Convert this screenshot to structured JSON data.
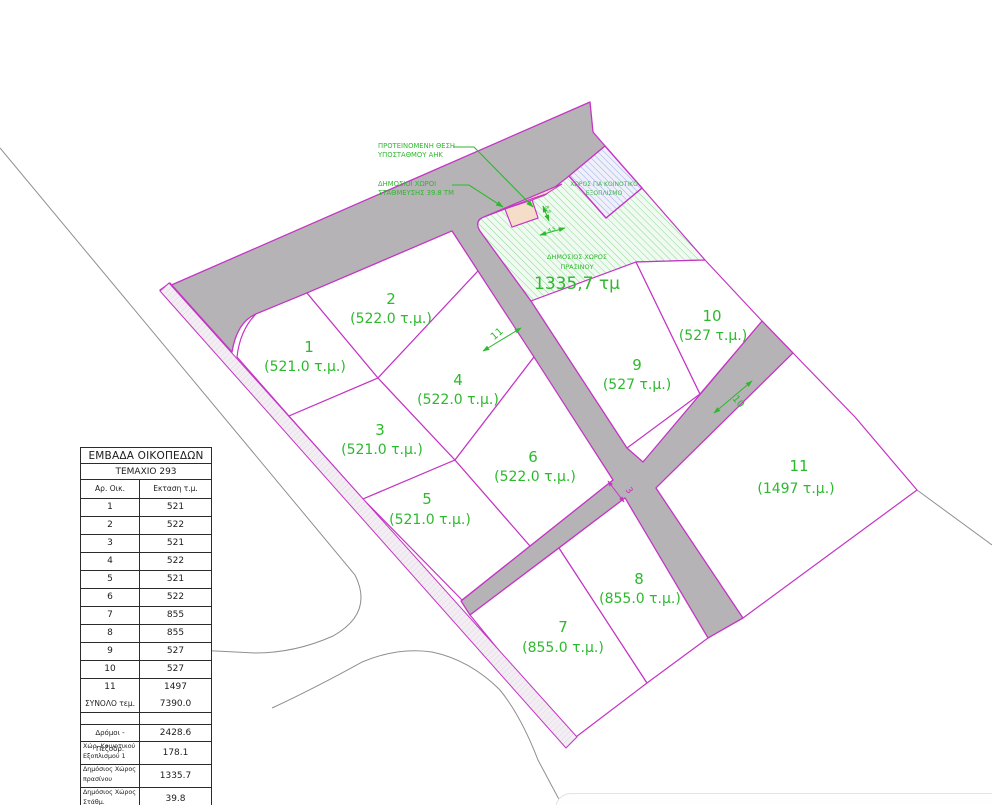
{
  "drawing_title": "Κατανομή οικοπέδων - σχέδιο διαχωρισμού",
  "colors": {
    "parcel_line_magenta": "#c435c4",
    "road_gray": "#b5b3b6",
    "plot_text_green": "#2db92d",
    "annotation_green": "#2db92d",
    "green_space_fill": "#effaf0",
    "green_space_hatch": "#8ed795",
    "community_fill": "#eef0fb",
    "community_hatch": "#9aa3dd",
    "parking_salmon": "#f6ddc9",
    "boundary_gray": "#8f8f8f",
    "table_text": "#1c1c1c"
  },
  "annotations": {
    "substation_line1": "ΠΡΟΤΕΙΝΟΜΕΝΗ ΘΕΣΗ",
    "substation_line2": "ΥΠΟΣΤΑΘΜΟΥ ΑΗΚ",
    "parking_line1": "ΔΗΜΟΣΙΟΙ ΧΩΡΟΙ",
    "parking_line2": "ΣΤΑΘΜΕΥΣΗΣ 39.8 ΤΜ",
    "community_line1": "ΧΩΡΟΣ ΓΙΑ ΚΟΙΝΟΤΙΚΟ",
    "community_line2": "ΕΞΟΠΛΙΣΜΟ",
    "green_line1": "ΔΗΜΟΣΙΟΣ ΧΩΡΟΣ",
    "green_line2": "ΠΡΑΣΙΝΟΥ",
    "green_area_value": "1335,7 τμ",
    "dim_road_11": "11",
    "dim_road_10": "10",
    "dim_path_3": "3",
    "dim_parking_h": "8.8",
    "dim_parking_w": "4.5"
  },
  "plots": [
    {
      "number": "1",
      "area_label": "(521.0 τ.μ.)"
    },
    {
      "number": "2",
      "area_label": "(522.0 τ.μ.)"
    },
    {
      "number": "3",
      "area_label": "(521.0 τ.μ.)"
    },
    {
      "number": "4",
      "area_label": "(522.0 τ.μ.)"
    },
    {
      "number": "5",
      "area_label": "(521.0 τ.μ.)"
    },
    {
      "number": "6",
      "area_label": "(522.0 τ.μ.)"
    },
    {
      "number": "7",
      "area_label": "(855.0 τ.μ.)"
    },
    {
      "number": "8",
      "area_label": "(855.0 τ.μ.)"
    },
    {
      "number": "9",
      "area_label": "(527 τ.μ.)"
    },
    {
      "number": "10",
      "area_label": "(527 τ.μ.)"
    },
    {
      "number": "11",
      "area_label": "(1497 τ.μ.)"
    }
  ],
  "table": {
    "title": "ΕΜΒΑΔΑ ΟΙΚΟΠΕΔΩΝ",
    "subtitle": "ΤΕΜΑΧΙΟ 293",
    "col_plot": "Αρ. Οικ.",
    "col_area": "Εκταση τ.μ.",
    "rows": [
      [
        "1",
        "521"
      ],
      [
        "2",
        "522"
      ],
      [
        "3",
        "521"
      ],
      [
        "4",
        "522"
      ],
      [
        "5",
        "521"
      ],
      [
        "6",
        "522"
      ],
      [
        "7",
        "855"
      ],
      [
        "8",
        "855"
      ],
      [
        "9",
        "527"
      ],
      [
        "10",
        "527"
      ],
      [
        "11",
        "1497"
      ]
    ],
    "total_label": "ΣΥΝΟΛΟ τεμ.",
    "total_value": "7390.0",
    "extra_rows": [
      {
        "label": "Δρόμοι - Πεζοδρ.",
        "value": "2428.6"
      },
      {
        "label": "Χώρ. Κοινοτικού Εξοπλισμού 1",
        "value": "178.1"
      },
      {
        "label": "Δημόσιος Χώρος πρασίνου",
        "value": "1335.7"
      },
      {
        "label": "Δημόσιος Χώρος Στάθμ.",
        "value": "39.8"
      }
    ]
  }
}
